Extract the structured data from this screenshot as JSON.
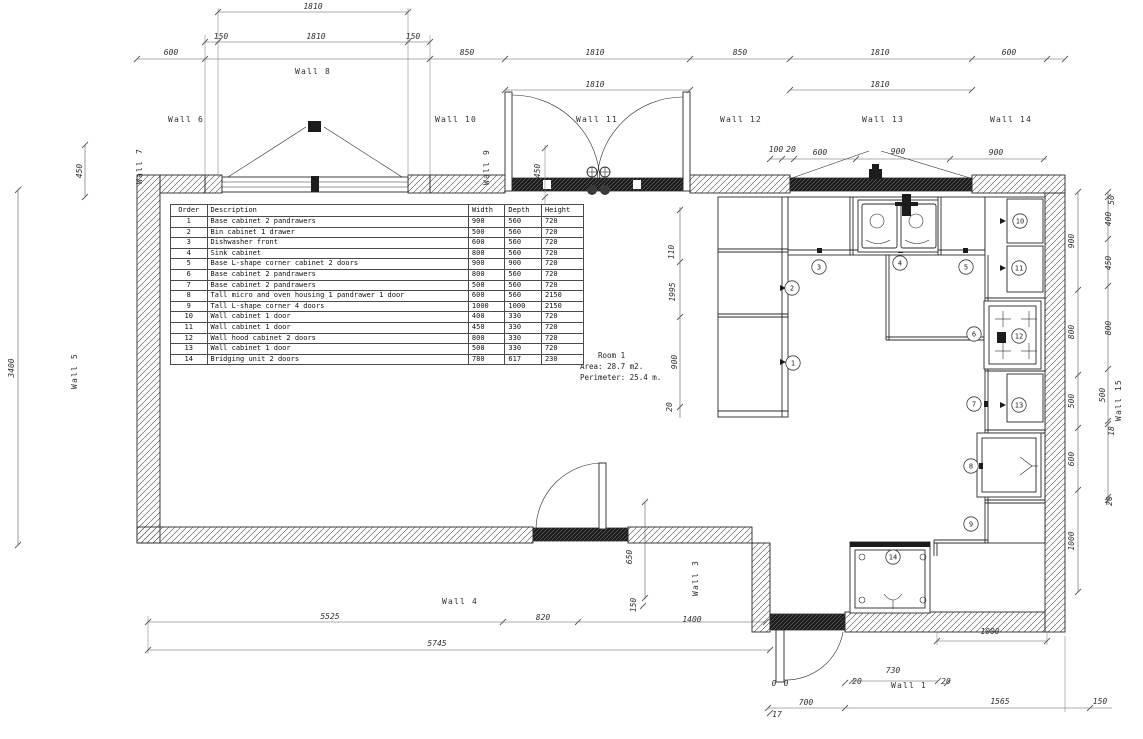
{
  "drawing": {
    "type": "kitchen floor plan",
    "colors": {
      "line": "#2a2a2a",
      "dim_text": "#2f2f2f",
      "wall_hatch": "#444444",
      "background": "#ffffff"
    }
  },
  "room": {
    "name": "Room 1",
    "area": "Area: 28.7 m2.",
    "perimeter": "Perimeter: 25.4 m."
  },
  "cabinet_table": {
    "headers": [
      "Order",
      "Description",
      "Width",
      "Depth",
      "Height"
    ],
    "rows": [
      {
        "order": "1",
        "description": "Base cabinet 2 pandrawers",
        "width": "900",
        "depth": "560",
        "height": "720"
      },
      {
        "order": "2",
        "description": "Bin cabinet 1 drawer",
        "width": "500",
        "depth": "560",
        "height": "720"
      },
      {
        "order": "3",
        "description": "Dishwasher front",
        "width": "600",
        "depth": "560",
        "height": "720"
      },
      {
        "order": "4",
        "description": "Sink cabinet",
        "width": "800",
        "depth": "560",
        "height": "720"
      },
      {
        "order": "5",
        "description": "Base L-shape corner cabinet 2 doors",
        "width": "900",
        "depth": "900",
        "height": "720"
      },
      {
        "order": "6",
        "description": "Base cabinet 2 pandrawers",
        "width": "800",
        "depth": "560",
        "height": "720"
      },
      {
        "order": "7",
        "description": "Base cabinet 2 pandrawers",
        "width": "500",
        "depth": "560",
        "height": "720"
      },
      {
        "order": "8",
        "description": "Tall micro and oven housing 1 pandrawer 1 door",
        "width": "600",
        "depth": "560",
        "height": "2150"
      },
      {
        "order": "9",
        "description": "Tall L-shape corner 4 doors",
        "width": "1000",
        "depth": "1000",
        "height": "2150"
      },
      {
        "order": "10",
        "description": "Wall cabinet 1 door",
        "width": "400",
        "depth": "330",
        "height": "720"
      },
      {
        "order": "11",
        "description": "Wall cabinet 1 door",
        "width": "450",
        "depth": "330",
        "height": "720"
      },
      {
        "order": "12",
        "description": "Wall hood cabinet 2 doors",
        "width": "800",
        "depth": "330",
        "height": "720"
      },
      {
        "order": "13",
        "description": "Wall cabinet 1 door",
        "width": "500",
        "depth": "330",
        "height": "720"
      },
      {
        "order": "14",
        "description": "Bridging unit 2 doors",
        "width": "780",
        "depth": "617",
        "height": "230"
      }
    ]
  },
  "wall_labels": [
    {
      "t": "Wall 8",
      "x": 313,
      "y": 74,
      "r": 0
    },
    {
      "t": "Wall 6",
      "x": 186,
      "y": 122,
      "r": 0
    },
    {
      "t": "Wall 10",
      "x": 456,
      "y": 122,
      "r": 0
    },
    {
      "t": "Wall 11",
      "x": 597,
      "y": 122,
      "r": 0
    },
    {
      "t": "Wall 12",
      "x": 741,
      "y": 122,
      "r": 0
    },
    {
      "t": "Wall 13",
      "x": 883,
      "y": 122,
      "r": 0
    },
    {
      "t": "Wall 14",
      "x": 1011,
      "y": 122,
      "r": 0
    },
    {
      "t": "Wall 7",
      "x": 142,
      "y": 166,
      "r": -90
    },
    {
      "t": "Wall 5",
      "x": 77,
      "y": 371,
      "r": -90
    },
    {
      "t": "Wall 9",
      "x": 489,
      "y": 167,
      "r": -90
    },
    {
      "t": "Wall 15",
      "x": 1121,
      "y": 400,
      "r": -90
    },
    {
      "t": "Wall 3",
      "x": 698,
      "y": 578,
      "r": -90
    },
    {
      "t": "Wall 4",
      "x": 460,
      "y": 604,
      "r": 0
    },
    {
      "t": "Wall 1",
      "x": 909,
      "y": 688,
      "r": 0
    }
  ],
  "dimension_labels": [
    {
      "t": "1810",
      "x": 313,
      "y": 9,
      "r": 0
    },
    {
      "t": "150",
      "x": 221,
      "y": 39,
      "r": 0
    },
    {
      "t": "1810",
      "x": 316,
      "y": 39,
      "r": 0
    },
    {
      "t": "150",
      "x": 413,
      "y": 39,
      "r": 0
    },
    {
      "t": "600",
      "x": 171,
      "y": 55,
      "r": 0
    },
    {
      "t": "850",
      "x": 467,
      "y": 55,
      "r": 0
    },
    {
      "t": "1810",
      "x": 595,
      "y": 55,
      "r": 0
    },
    {
      "t": "850",
      "x": 740,
      "y": 55,
      "r": 0
    },
    {
      "t": "1810",
      "x": 880,
      "y": 55,
      "r": 0
    },
    {
      "t": "600",
      "x": 1009,
      "y": 55,
      "r": 0
    },
    {
      "t": "1810",
      "x": 595,
      "y": 87,
      "r": 0
    },
    {
      "t": "1810",
      "x": 880,
      "y": 87,
      "r": 0
    },
    {
      "t": "100",
      "x": 776,
      "y": 152,
      "r": 0
    },
    {
      "t": "20",
      "x": 791,
      "y": 152,
      "r": 0
    },
    {
      "t": "600",
      "x": 820,
      "y": 155,
      "r": 0
    },
    {
      "t": "900",
      "x": 898,
      "y": 154,
      "r": 0
    },
    {
      "t": "900",
      "x": 996,
      "y": 155,
      "r": 0
    },
    {
      "t": "450",
      "x": 82,
      "y": 171,
      "r": -90
    },
    {
      "t": "3400",
      "x": 14,
      "y": 368,
      "r": -90
    },
    {
      "t": "450",
      "x": 540,
      "y": 171,
      "r": -90
    },
    {
      "t": "110",
      "x": 674,
      "y": 252,
      "r": -90
    },
    {
      "t": "1995",
      "x": 675,
      "y": 292,
      "r": -90
    },
    {
      "t": "900",
      "x": 677,
      "y": 362,
      "r": -90
    },
    {
      "t": "20",
      "x": 672,
      "y": 407,
      "r": -90
    },
    {
      "t": "900",
      "x": 1074,
      "y": 241,
      "r": -90
    },
    {
      "t": "800",
      "x": 1074,
      "y": 332,
      "r": -90
    },
    {
      "t": "500",
      "x": 1074,
      "y": 401,
      "r": -90
    },
    {
      "t": "600",
      "x": 1074,
      "y": 459,
      "r": -90
    },
    {
      "t": "1000",
      "x": 1074,
      "y": 541,
      "r": -90
    },
    {
      "t": "50",
      "x": 1114,
      "y": 200,
      "r": -90
    },
    {
      "t": "400",
      "x": 1111,
      "y": 219,
      "r": -90
    },
    {
      "t": "450",
      "x": 1111,
      "y": 263,
      "r": -90
    },
    {
      "t": "800",
      "x": 1111,
      "y": 328,
      "r": -90
    },
    {
      "t": "500",
      "x": 1105,
      "y": 395,
      "r": -90
    },
    {
      "t": "18",
      "x": 1114,
      "y": 431,
      "r": -90
    },
    {
      "t": "20",
      "x": 1112,
      "y": 501,
      "r": -90
    },
    {
      "t": "650",
      "x": 632,
      "y": 557,
      "r": -90
    },
    {
      "t": "150",
      "x": 636,
      "y": 605,
      "r": -90
    },
    {
      "t": "5525",
      "x": 330,
      "y": 619,
      "r": 0
    },
    {
      "t": "820",
      "x": 543,
      "y": 620,
      "r": 0
    },
    {
      "t": "1400",
      "x": 692,
      "y": 622,
      "r": 0
    },
    {
      "t": "5745",
      "x": 437,
      "y": 646,
      "r": 0
    },
    {
      "t": "1000",
      "x": 990,
      "y": 634,
      "r": 0
    },
    {
      "t": "730",
      "x": 893,
      "y": 673,
      "r": 0
    },
    {
      "t": "20",
      "x": 857,
      "y": 684,
      "r": 0
    },
    {
      "t": "20",
      "x": 946,
      "y": 684,
      "r": 0
    },
    {
      "t": "700",
      "x": 806,
      "y": 705,
      "r": 0
    },
    {
      "t": "1565",
      "x": 1000,
      "y": 704,
      "r": 0
    },
    {
      "t": "150",
      "x": 1100,
      "y": 704,
      "r": 0
    },
    {
      "t": "17",
      "x": 777,
      "y": 717,
      "r": 0
    },
    {
      "t": "0",
      "x": 774,
      "y": 686,
      "r": 0
    },
    {
      "t": "0",
      "x": 786,
      "y": 686,
      "r": 0
    }
  ],
  "balloons": [
    {
      "n": "1",
      "x": 793,
      "y": 363
    },
    {
      "n": "2",
      "x": 792,
      "y": 288
    },
    {
      "n": "3",
      "x": 819,
      "y": 267
    },
    {
      "n": "4",
      "x": 900,
      "y": 263
    },
    {
      "n": "5",
      "x": 966,
      "y": 267
    },
    {
      "n": "6",
      "x": 974,
      "y": 334
    },
    {
      "n": "7",
      "x": 974,
      "y": 404
    },
    {
      "n": "8",
      "x": 971,
      "y": 466
    },
    {
      "n": "9",
      "x": 971,
      "y": 524
    },
    {
      "n": "10",
      "x": 1020,
      "y": 221
    },
    {
      "n": "11",
      "x": 1019,
      "y": 268
    },
    {
      "n": "12",
      "x": 1019,
      "y": 336
    },
    {
      "n": "13",
      "x": 1019,
      "y": 405
    },
    {
      "n": "14",
      "x": 893,
      "y": 557
    }
  ]
}
